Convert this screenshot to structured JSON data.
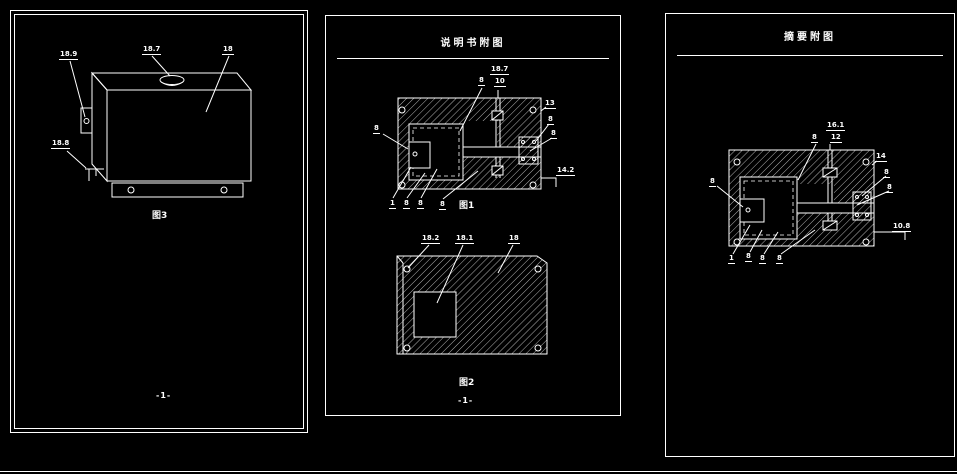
{
  "canvas": {
    "background": "#000000",
    "line_color": "#ffffff"
  },
  "left_sheet": {
    "caption": "图3",
    "page_number": "-1-",
    "labels": [
      {
        "t": "18.9",
        "x": 48,
        "y": 40
      },
      {
        "t": "18.7",
        "x": 131,
        "y": 35
      },
      {
        "t": "18",
        "x": 211,
        "y": 35
      },
      {
        "t": "18.8",
        "x": 40,
        "y": 129
      }
    ]
  },
  "middle_sheet": {
    "title": "说明书附图",
    "fig1_caption": "图1",
    "fig2_caption": "图2",
    "page_number": "-1-",
    "fig1_labels": [
      {
        "t": "8",
        "x": 152,
        "y": 61
      },
      {
        "t": "18.7",
        "x": 164,
        "y": 50
      },
      {
        "t": "10",
        "x": 168,
        "y": 62
      },
      {
        "t": "13",
        "x": 218,
        "y": 84
      },
      {
        "t": "8",
        "x": 221,
        "y": 100
      },
      {
        "t": "8",
        "x": 224,
        "y": 114
      },
      {
        "t": "8",
        "x": 47,
        "y": 109
      },
      {
        "t": "1",
        "x": 63,
        "y": 184
      },
      {
        "t": "8",
        "x": 77,
        "y": 184
      },
      {
        "t": "8",
        "x": 91,
        "y": 184
      },
      {
        "t": "8",
        "x": 113,
        "y": 185
      },
      {
        "t": "14.2",
        "x": 230,
        "y": 151
      }
    ],
    "fig2_labels": [
      {
        "t": "18.2",
        "x": 95,
        "y": 219
      },
      {
        "t": "18.1",
        "x": 129,
        "y": 219
      },
      {
        "t": "18",
        "x": 182,
        "y": 219
      }
    ]
  },
  "right_sheet": {
    "title": "摘要附图",
    "labels": [
      {
        "t": "8",
        "x": 145,
        "y": 120
      },
      {
        "t": "16.1",
        "x": 160,
        "y": 108
      },
      {
        "t": "12",
        "x": 164,
        "y": 120
      },
      {
        "t": "14",
        "x": 209,
        "y": 139
      },
      {
        "t": "8",
        "x": 217,
        "y": 155
      },
      {
        "t": "8",
        "x": 220,
        "y": 170
      },
      {
        "t": "8",
        "x": 43,
        "y": 164
      },
      {
        "t": "1",
        "x": 62,
        "y": 241
      },
      {
        "t": "8",
        "x": 79,
        "y": 239
      },
      {
        "t": "8",
        "x": 93,
        "y": 241
      },
      {
        "t": "8",
        "x": 110,
        "y": 241
      },
      {
        "t": "10.8",
        "x": 226,
        "y": 209
      }
    ]
  }
}
